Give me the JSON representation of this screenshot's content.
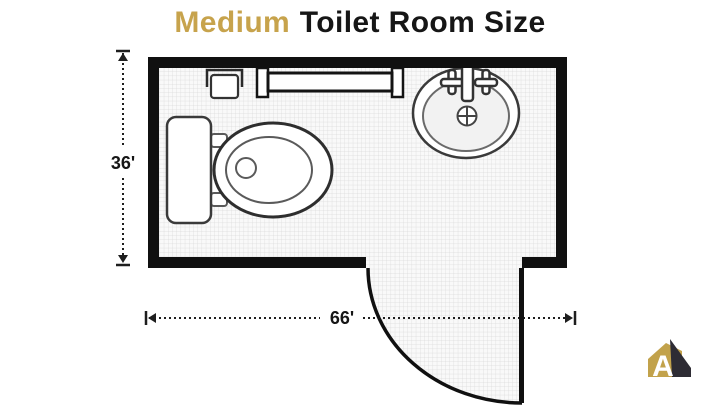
{
  "title": {
    "highlight": "Medium",
    "rest": "Toilet Room Size"
  },
  "dimensions": {
    "height_label": "36'",
    "width_label": "66'"
  },
  "room": {
    "fixtures": [
      "toilet",
      "sink",
      "towel-bar",
      "toilet-paper-holder",
      "door-swing"
    ]
  },
  "logo": {
    "letter": "A"
  },
  "colors": {
    "accent_gold": "#C7A34C",
    "title_black": "#161616",
    "wall_black": "#101010",
    "floor_fill": "#F9F9F9",
    "grid_line": "#D9D9D9",
    "logo_gold": "#C2A24B",
    "logo_dark": "#2E2C34"
  }
}
